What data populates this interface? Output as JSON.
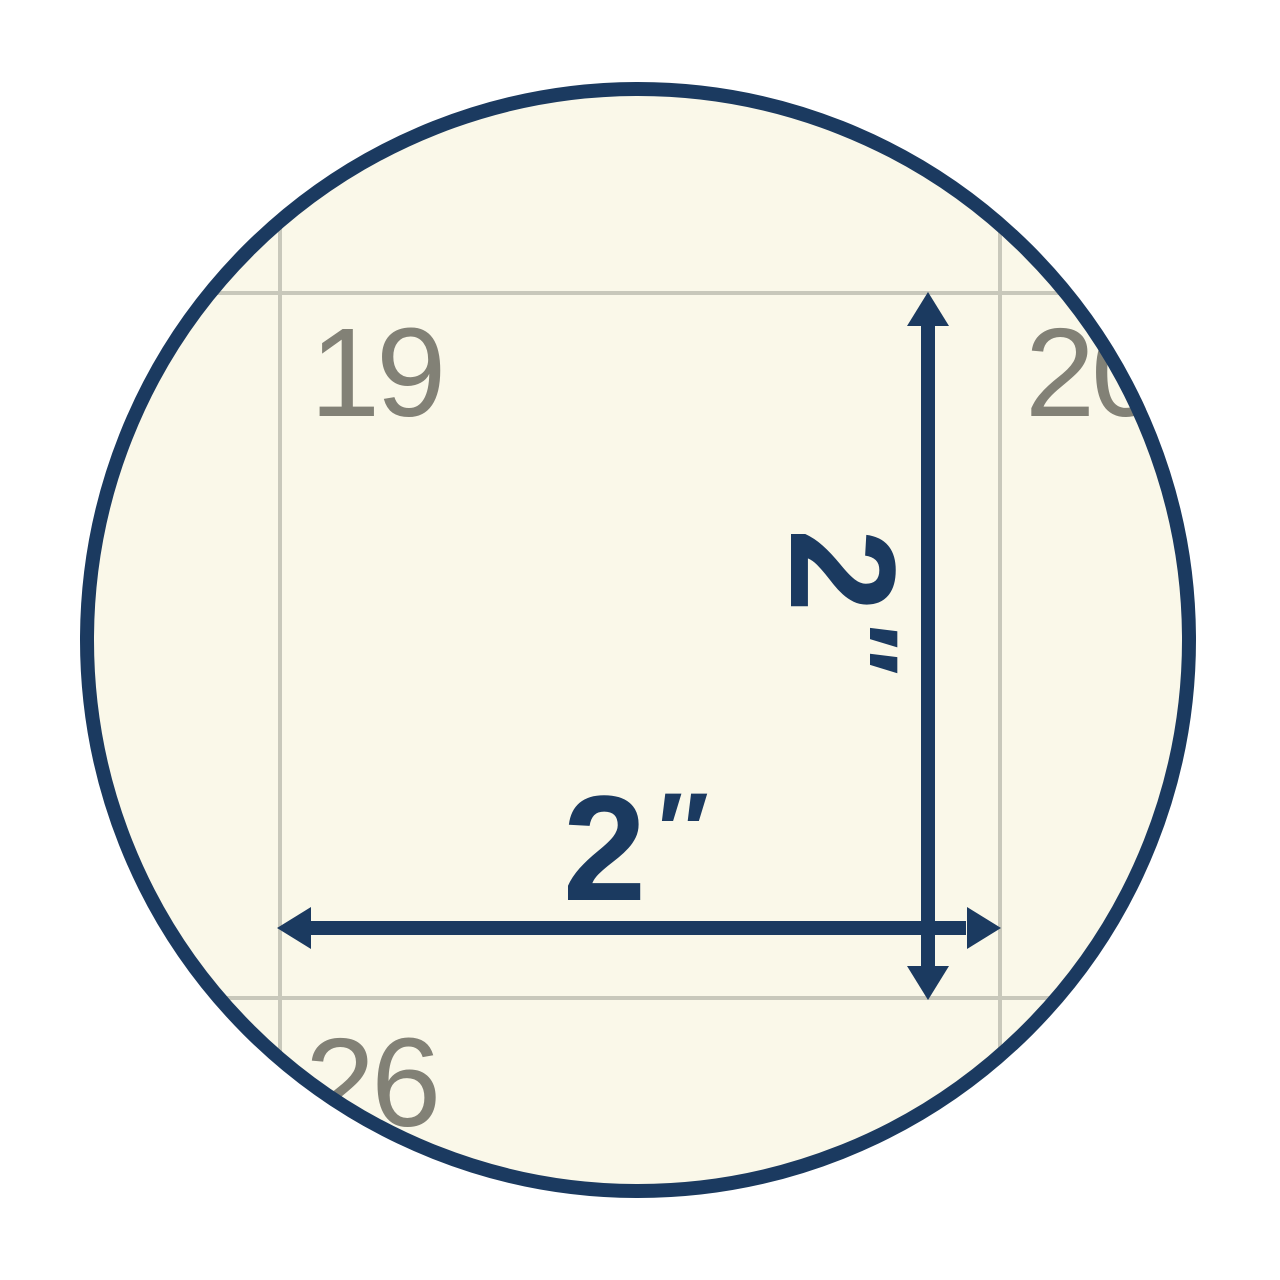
{
  "colors": {
    "navy": "#1b3a60",
    "cream": "#faf8e9",
    "gridline": "#c8c8bb",
    "dategray": "#828176",
    "bg": "#ffffff"
  },
  "calendar": {
    "dates": {
      "top_left": "19",
      "top_right": "20",
      "bottom_left": "26"
    }
  },
  "dimensions": {
    "width": {
      "value": "2",
      "unit": "″"
    },
    "height": {
      "value": "2",
      "unit": "″"
    }
  }
}
